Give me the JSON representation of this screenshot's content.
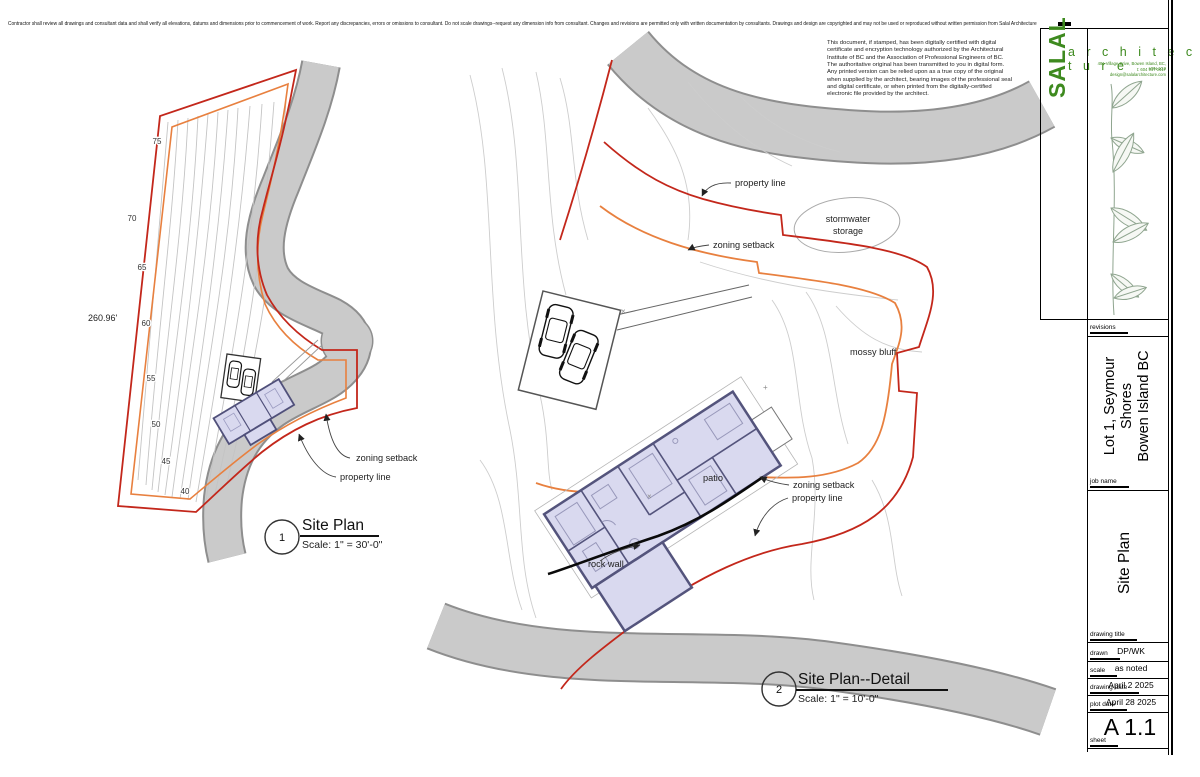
{
  "disclaimer": "Contractor shall review all drawings and consultant data and shall verify all elevations, datums and dimensions prior to commencement of work. Report any discrepancies, errors or omissions to consultant. Do not scale drawings--request any dimension info from consultant. Changes and revisions are permitted only with written documentation by consultants. Drawings and design are copyrighted and may not be used or reproduced without written permission from Salal Architecture",
  "certificate": "This document, if stamped, has been digitally certified with digital certificate and encryption technology authorized by the Architectural Institute of BC and the Association of Professional Engineers of BC. The authoritative original has been transmitted to you in digital form. Any printed version can be relied upon as a true copy of the original when supplied by the architect, bearing images of the professional seal and digital certificate, or when printed from the digitally-certified electronic file provided by the architect.",
  "logo": {
    "name": "SALAL",
    "tagline": "a r c h i t e c t u r e",
    "address_line1": "481 Village Drive, Bowen Island, BC, V0N 1G2",
    "address_line2": "t: 604 947 0417   design@salalarchitecture.com"
  },
  "titleblock": {
    "revisions_label": "revisions",
    "job_name_label": "job name",
    "job_name_line1": "Lot 1, Seymour Shores",
    "job_name_line2": "Bowen Island BC",
    "drawing_title_label": "drawing title",
    "drawing_title": "Site Plan",
    "drawn_label": "drawn",
    "drawn": "DP/WK",
    "scale_label": "scale",
    "scale": "as noted",
    "drawing_date_label": "drawing date",
    "drawing_date": "April 2 2025",
    "plot_date_label": "plot date",
    "plot_date": "April 28 2025",
    "sheet_label": "sheet",
    "sheet": "A 1.1"
  },
  "plan1": {
    "number": "1",
    "title": "Site Plan",
    "scale": "Scale: 1\" = 30'-0\"",
    "dimension": "260.96'",
    "contours": [
      "75",
      "70",
      "65",
      "60",
      "55",
      "50",
      "45",
      "40"
    ],
    "labels": {
      "zoning_setback": "zoning setback",
      "property_line": "property line"
    }
  },
  "plan2": {
    "number": "2",
    "title": "Site Plan--Detail",
    "scale": "Scale: 1\" = 10'-0\"",
    "labels": {
      "property_line_top": "property line",
      "zoning_setback_top": "zoning setback",
      "stormwater_1": "stormwater",
      "stormwater_2": "storage",
      "mossy_bluff": "mossy bluff",
      "patio": "patio",
      "zoning_setback_bottom": "zoning setback",
      "property_line_bottom": "property line",
      "rock_wall": "rock wall"
    }
  },
  "colors": {
    "property_line": "#c3271b",
    "zoning_setback": "#e8803f",
    "road_fill": "#cacaca",
    "road_edge": "#8e8e8e",
    "building_fill": "#d9d9ef",
    "wall_stroke": "#54547c",
    "logo_green": "#3e8a1f"
  }
}
